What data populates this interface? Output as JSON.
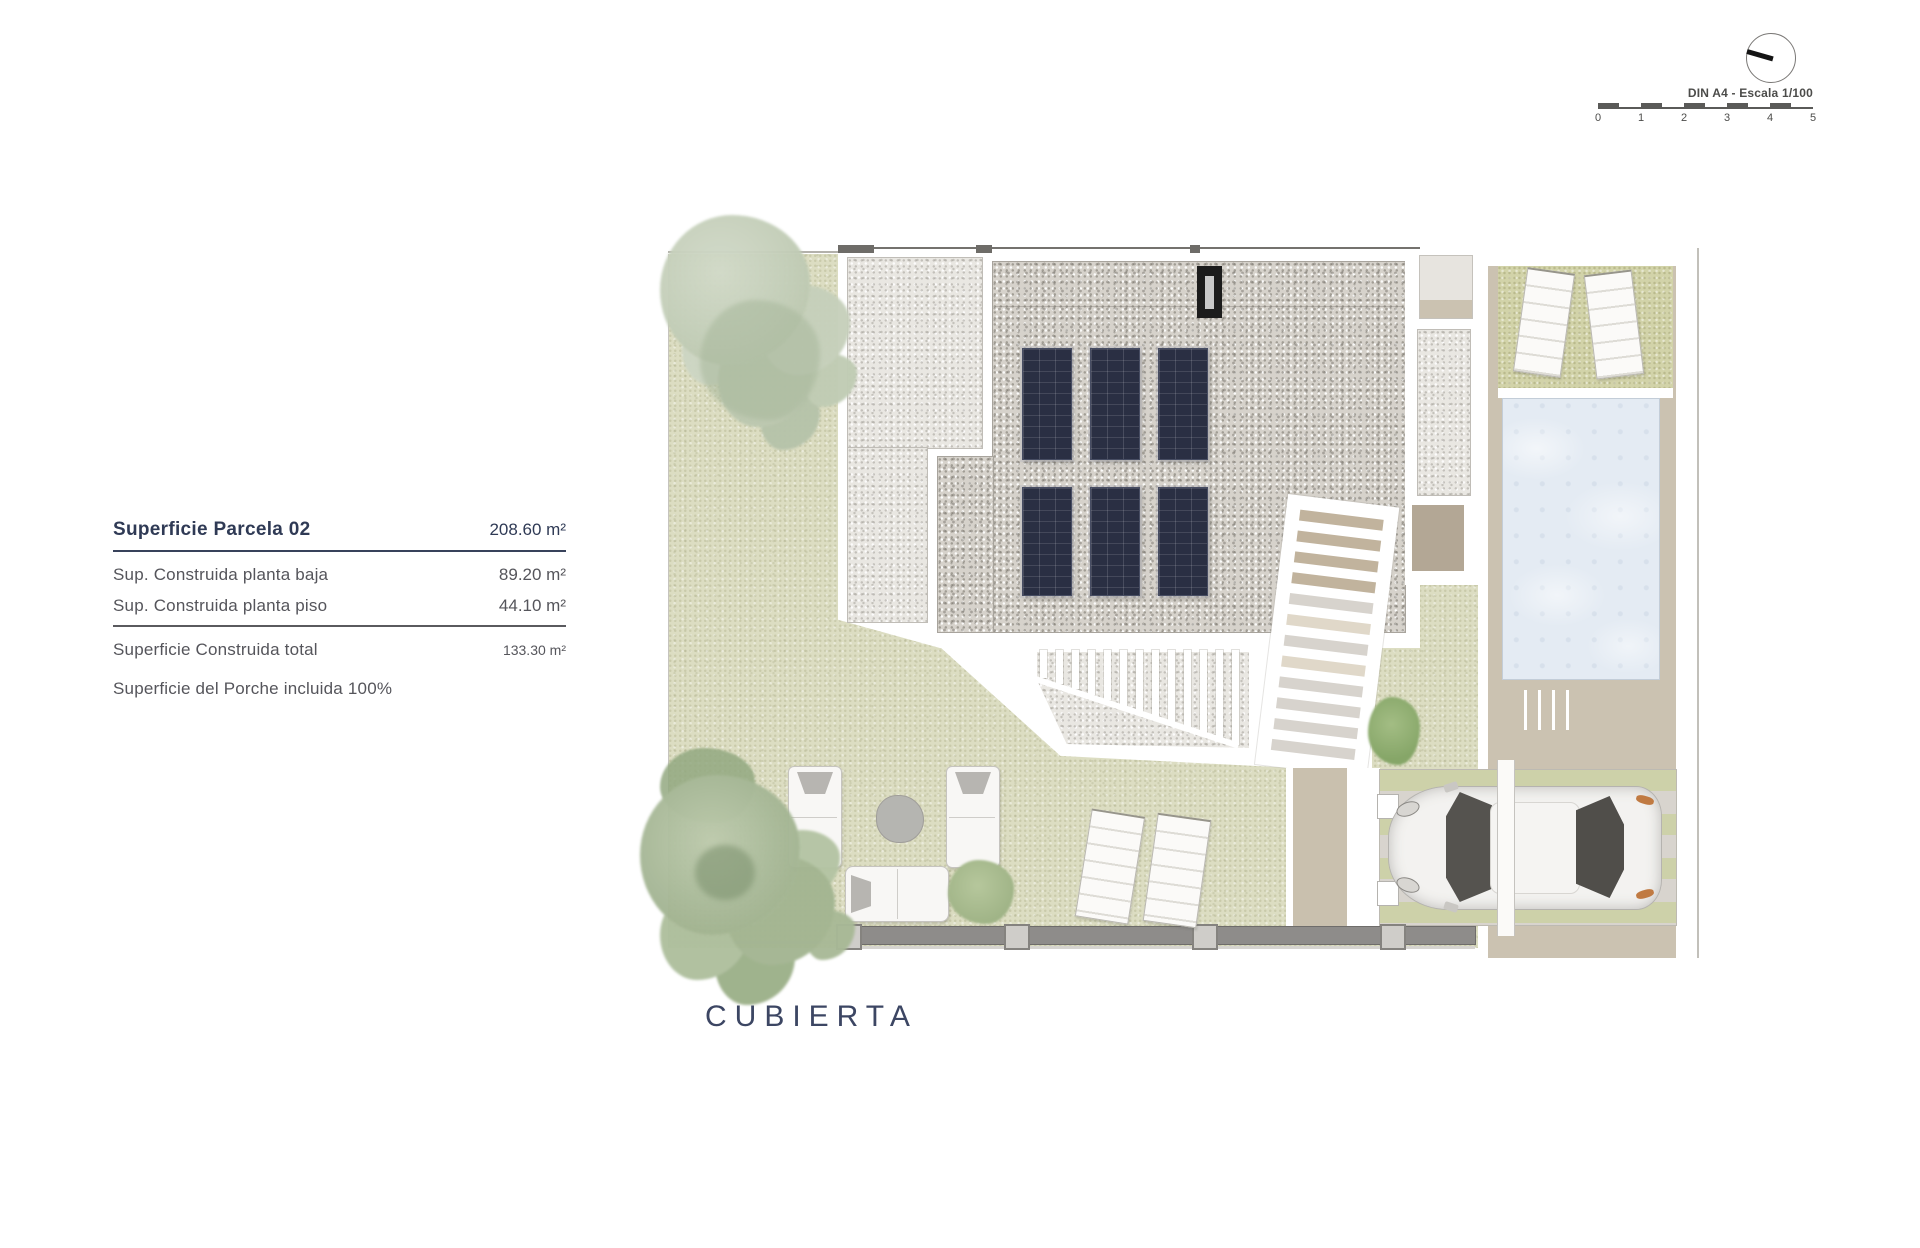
{
  "page": {
    "plan_title": "CUBIERTA"
  },
  "legend": {
    "title": {
      "label": "Superficie Parcela 02",
      "value": "208.60 m²"
    },
    "rows": [
      {
        "label": "Sup. Construida planta baja",
        "value": "89.20 m²"
      },
      {
        "label": "Sup. Construida planta piso",
        "value": "44.10 m²"
      }
    ],
    "total": {
      "label": "Superficie Construida total",
      "value": "133.30 m²"
    },
    "note": "Superficie del Porche incluida 100%"
  },
  "scale_bar": {
    "label": "DIN A4 - Escala 1/100",
    "ticks": [
      "0",
      "1",
      "2",
      "3",
      "4",
      "5"
    ]
  },
  "palette": {
    "lawn_green": "#dcddc2",
    "garden_patch_green": "#d2d3a9",
    "gravel_light": "#e9e7e2",
    "gravel_dark": "#d6d2cb",
    "deck_tan": "#cbc2b1",
    "pool_water_blue": "#e4ebf3",
    "solar_panel_navy": "#2a2f43",
    "legend_navy": "#2f3a55",
    "body_text_gray": "#55555b",
    "boundary_wall_gray": "#8e8c8a",
    "taillight_orange": "#c07a42"
  }
}
